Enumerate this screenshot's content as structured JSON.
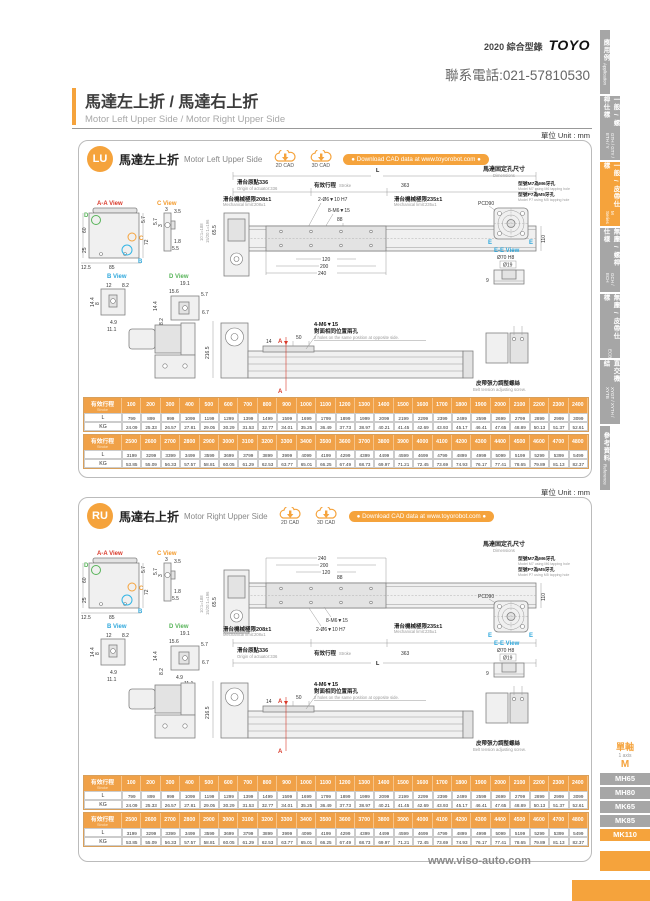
{
  "header": {
    "catalog": "2020 綜合型錄",
    "logo": "TOYO",
    "phone": "聯系電話:021-57810530"
  },
  "page_title": {
    "zh": "馬達左上折 / 馬達右上折",
    "en": "Motor Left Upper Side / Motor Right Upper Side"
  },
  "side_tabs": [
    {
      "zh": "應用例",
      "en": "Application"
    },
    {
      "zh": "一般 / 螺桿仕樣",
      "en": "GTH / GTY / ETH / Y"
    },
    {
      "zh": "一般 / 皮帶仕樣",
      "en": "M Series"
    },
    {
      "zh": "無塵 / 螺桿仕樣",
      "en": "GCH / ECH"
    },
    {
      "zh": "無塵 / 皮帶仕樣",
      "en": "ECB"
    },
    {
      "zh": "直交機結",
      "en": "XYGT / XYTH / XYTB"
    },
    {
      "zh": "參考資料",
      "en": "Reference"
    }
  ],
  "model_nav": {
    "group_zh": "單軸",
    "group_en": "1 axis",
    "series": "M",
    "items": [
      {
        "label": "MH65"
      },
      {
        "label": "MH80"
      },
      {
        "label": "MK65"
      },
      {
        "label": "MK85"
      },
      {
        "label": "MK110"
      }
    ]
  },
  "footer": {
    "url": "www.viso-auto.com"
  },
  "panels": [
    {
      "code": "LU",
      "title_zh": "馬達左上折",
      "title_en": "Motor Left Upper Side",
      "unit": "單位 Unit : mm",
      "cad2d": "2D CAD",
      "cad3d": "3D CAD",
      "download": "● Download CAD data at www.toyorobot.com ●",
      "views": {
        "aa": {
          "label": "A-A View",
          "d57": "5.7",
          "d72": "72",
          "d60": "60",
          "d25": "25",
          "d125": "12.5",
          "d85": "85",
          "mD": "D",
          "mC": "C",
          "mB": "B"
        },
        "c": {
          "label": "C View",
          "d3a": "3",
          "d35": "3.5",
          "d57": "5.7",
          "d3b": "3",
          "d18": "1.8",
          "d55": "5.5"
        },
        "b": {
          "label": "B View",
          "d12": "12",
          "d82": "8.2",
          "d144": "14.4",
          "d8": "8",
          "d49": "4.9",
          "d111": "11.1"
        },
        "d": {
          "label": "D View",
          "d191": "19.1",
          "d156": "15.6",
          "d57": "5.7",
          "d144": "14.4",
          "d82": "8.2",
          "d49": "4.9",
          "d67": "6.7",
          "d111": "11.1",
          "d12": "12"
        }
      },
      "main": {
        "L": "L",
        "origin_zh": "滑台原點336",
        "origin_en": "Origin of actuator:336",
        "stroke_zh": "有效行程",
        "stroke_en": "Stroke",
        "d363": "363",
        "liml_zh": "滑台機械極限208±1",
        "liml_en": "Mechanical limit:208±1",
        "limr_zh": "滑台機械極限235±1",
        "limr_en": "Mechanical limit:235±1",
        "c1": "2-Ø6▼10 H7",
        "c2": "8-M6▼15",
        "d88": "88",
        "d120": "120",
        "d200": "200",
        "d240": "240",
        "d110": "110",
        "d655": "65.5",
        "r1": "10:1=188",
        "r2": "15/20:1=196"
      },
      "motor": {
        "t_zh": "馬達固定孔尺寸",
        "t_en": "Dimensions",
        "m7_zh": "型號M7為M6牙孔",
        "m7_en": "Model M7 using M6 tapping hole",
        "p7_zh": "型號P7為M5牙孔",
        "p7_en": "Model P7 using M5 tapping hole",
        "pcd": "PCD90",
        "e": "E",
        "ee": "E-E View",
        "d70": "Ø70 H8",
        "d19": "Ø19",
        "d9": "9"
      },
      "side": {
        "d2165": "216.5",
        "d14": "14",
        "d50": "50",
        "c1": "4-M6▼15",
        "holes_zh": "對面相同位置兩孔",
        "holes_en": "2 holes on the same position at opposite side.",
        "a": "A",
        "belt_zh": "皮帶張力調整螺絲",
        "belt_en": "Belt tension adjusting screw."
      },
      "tables": [
        {
          "h_zh": "有效行程",
          "h_en": "Stroke",
          "rl": "L",
          "rk": "KG",
          "strokes": [
            "100",
            "200",
            "300",
            "400",
            "500",
            "600",
            "700",
            "800",
            "900",
            "1000",
            "1100",
            "1200",
            "1300",
            "1400",
            "1500",
            "1600",
            "1700",
            "1800",
            "1900",
            "2000",
            "2100",
            "2200",
            "2300",
            "2400"
          ],
          "L": [
            "799",
            "899",
            "999",
            "1099",
            "1199",
            "1299",
            "1399",
            "1499",
            "1599",
            "1699",
            "1799",
            "1899",
            "1999",
            "2099",
            "2199",
            "2299",
            "2399",
            "2499",
            "2599",
            "2699",
            "2799",
            "2899",
            "2999",
            "3099"
          ],
          "KG": [
            "24.09",
            "25.33",
            "26.57",
            "27.81",
            "29.05",
            "30.29",
            "31.53",
            "32.77",
            "34.01",
            "35.25",
            "36.49",
            "37.73",
            "38.97",
            "40.21",
            "41.45",
            "42.69",
            "43.93",
            "45.17",
            "46.41",
            "47.65",
            "48.89",
            "50.13",
            "51.37",
            "52.61"
          ]
        },
        {
          "h_zh": "有效行程",
          "h_en": "Stroke",
          "rl": "L",
          "rk": "KG",
          "strokes": [
            "2500",
            "2600",
            "2700",
            "2800",
            "2900",
            "3000",
            "3100",
            "3200",
            "3300",
            "3400",
            "3500",
            "3600",
            "3700",
            "3800",
            "3900",
            "4000",
            "4100",
            "4200",
            "4300",
            "4400",
            "4500",
            "4600",
            "4700",
            "4800"
          ],
          "L": [
            "3199",
            "3299",
            "3399",
            "3499",
            "3599",
            "3699",
            "3799",
            "3899",
            "3999",
            "4099",
            "4199",
            "4299",
            "4399",
            "4499",
            "4599",
            "4699",
            "4799",
            "4899",
            "4999",
            "5099",
            "5199",
            "5299",
            "5399",
            "5499"
          ],
          "KG": [
            "53.85",
            "55.09",
            "56.33",
            "57.57",
            "58.81",
            "60.05",
            "61.29",
            "62.53",
            "63.77",
            "65.01",
            "66.25",
            "67.49",
            "68.73",
            "69.97",
            "71.21",
            "72.45",
            "73.69",
            "74.93",
            "76.17",
            "77.41",
            "78.65",
            "79.89",
            "81.13",
            "82.37"
          ]
        }
      ]
    },
    {
      "code": "RU",
      "title_zh": "馬達右上折",
      "title_en": "Motor Right Upper Side",
      "unit": "單位 Unit : mm",
      "cad2d": "2D CAD",
      "cad3d": "3D CAD",
      "download": "● Download CAD data at www.toyorobot.com ●",
      "views": {
        "aa": {
          "label": "A-A View",
          "d57": "5.7",
          "d72": "72",
          "d60": "60",
          "d25": "25",
          "d125": "12.5",
          "d85": "85",
          "mD": "D",
          "mC": "C",
          "mB": "B"
        },
        "c": {
          "label": "C View",
          "d3a": "3",
          "d35": "3.5",
          "d57": "5.7",
          "d3b": "3",
          "d18": "1.8",
          "d55": "5.5"
        },
        "b": {
          "label": "B View",
          "d12": "12",
          "d82": "8.2",
          "d144": "14.4",
          "d8": "8",
          "d49": "4.9",
          "d111": "11.1"
        },
        "d": {
          "label": "D View",
          "d191": "19.1",
          "d156": "15.6",
          "d57": "5.7",
          "d144": "14.4",
          "d82": "8.2",
          "d49": "4.9",
          "d67": "6.7",
          "d111": "11.1",
          "d12": "12"
        }
      },
      "main": {
        "L": "L",
        "origin_zh": "滑台原點336",
        "origin_en": "Origin of actuator:336",
        "stroke_zh": "有效行程",
        "stroke_en": "Stroke",
        "d363": "363",
        "liml_zh": "滑台機械極限208±1",
        "liml_en": "Mechanical limit:208±1",
        "limr_zh": "滑台機械極限235±1",
        "limr_en": "Mechanical limit:235±1",
        "c1": "2-Ø6▼10 H7",
        "c2": "8-M6▼15",
        "d88": "88",
        "d120": "120",
        "d200": "200",
        "d240": "240",
        "d110": "110",
        "d655": "65.5",
        "r1": "10:1=188",
        "r2": "15/20:1=196"
      },
      "motor": {
        "t_zh": "馬達固定孔尺寸",
        "t_en": "Dimensions",
        "m7_zh": "型號M7為M6牙孔",
        "m7_en": "Model M7 using M6 tapping hole",
        "p7_zh": "型號P7為M5牙孔",
        "p7_en": "Model P7 using M5 tapping hole",
        "pcd": "PCD90",
        "e": "E",
        "ee": "E-E View",
        "d70": "Ø70 H8",
        "d19": "Ø19",
        "d9": "9"
      },
      "side": {
        "d2165": "216.5",
        "d14": "14",
        "d50": "50",
        "c1": "4-M6▼15",
        "holes_zh": "對面相同位置兩孔",
        "holes_en": "2 holes on the same position at opposite side.",
        "a": "A",
        "belt_zh": "皮帶張力調整螺絲",
        "belt_en": "Belt tension adjusting screw."
      },
      "tables": [
        {
          "h_zh": "有效行程",
          "h_en": "Stroke",
          "rl": "L",
          "rk": "KG",
          "strokes": [
            "100",
            "200",
            "300",
            "400",
            "500",
            "600",
            "700",
            "800",
            "900",
            "1000",
            "1100",
            "1200",
            "1300",
            "1400",
            "1500",
            "1600",
            "1700",
            "1800",
            "1900",
            "2000",
            "2100",
            "2200",
            "2300",
            "2400"
          ],
          "L": [
            "799",
            "899",
            "999",
            "1099",
            "1199",
            "1299",
            "1399",
            "1499",
            "1599",
            "1699",
            "1799",
            "1899",
            "1999",
            "2099",
            "2199",
            "2299",
            "2399",
            "2499",
            "2599",
            "2699",
            "2799",
            "2899",
            "2999",
            "3099"
          ],
          "KG": [
            "24.09",
            "25.33",
            "26.57",
            "27.81",
            "29.05",
            "30.29",
            "31.53",
            "32.77",
            "34.01",
            "35.25",
            "36.49",
            "37.73",
            "38.97",
            "40.21",
            "41.45",
            "42.69",
            "43.93",
            "45.17",
            "46.41",
            "47.65",
            "48.89",
            "50.13",
            "51.37",
            "52.61"
          ]
        },
        {
          "h_zh": "有效行程",
          "h_en": "Stroke",
          "rl": "L",
          "rk": "KG",
          "strokes": [
            "2500",
            "2600",
            "2700",
            "2800",
            "2900",
            "3000",
            "3100",
            "3200",
            "3300",
            "3400",
            "3500",
            "3600",
            "3700",
            "3800",
            "3900",
            "4000",
            "4100",
            "4200",
            "4300",
            "4400",
            "4500",
            "4600",
            "4700",
            "4800"
          ],
          "L": [
            "3199",
            "3299",
            "3399",
            "3499",
            "3599",
            "3699",
            "3799",
            "3899",
            "3999",
            "4099",
            "4199",
            "4299",
            "4399",
            "4499",
            "4599",
            "4699",
            "4799",
            "4899",
            "4999",
            "5099",
            "5199",
            "5299",
            "5399",
            "5499"
          ],
          "KG": [
            "53.85",
            "55.09",
            "56.33",
            "57.57",
            "58.81",
            "60.05",
            "61.29",
            "62.53",
            "63.77",
            "65.01",
            "66.25",
            "67.49",
            "68.73",
            "69.97",
            "71.21",
            "72.45",
            "73.69",
            "74.93",
            "76.17",
            "77.41",
            "78.65",
            "79.89",
            "81.13",
            "82.37"
          ]
        }
      ]
    }
  ]
}
